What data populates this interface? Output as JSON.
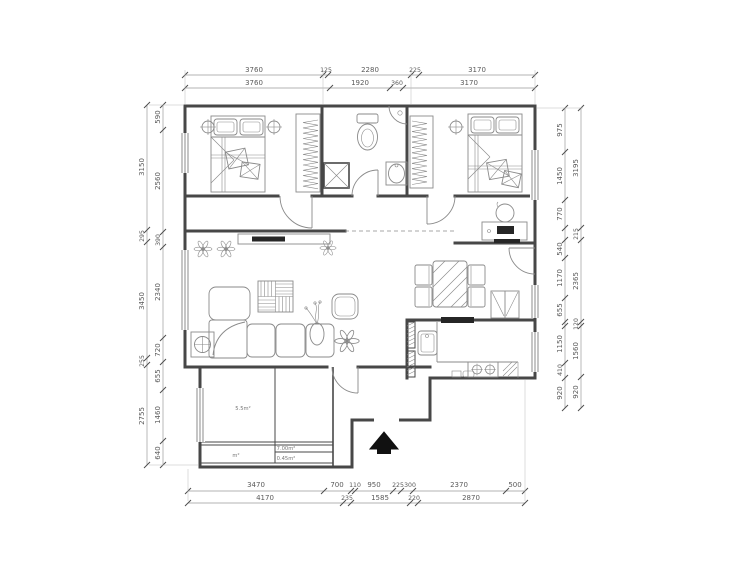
{
  "colors": {
    "background": "#ffffff",
    "wall": "#474747",
    "furniture": "#8a8a8a",
    "dim_line": "#9a9a9a",
    "dim_text": "#5a5a5a",
    "dark_fill": "#262626"
  },
  "dimensions": {
    "top_row1": [
      "3760",
      "125",
      "2280",
      "225",
      "3170"
    ],
    "top_row2": [
      "3760",
      "1920",
      "360",
      "3170"
    ],
    "bottom_row1": [
      "3470",
      "700",
      "110",
      "950",
      "225",
      "300",
      "2370",
      "500"
    ],
    "bottom_row2": [
      "4170",
      "235",
      "1585",
      "220",
      "2870"
    ],
    "left_outer": [
      "3150",
      "295",
      "3450",
      "255",
      "2755"
    ],
    "left_inner": [
      "590",
      "2560",
      "390",
      "2340",
      "720",
      "655",
      "1460",
      "640"
    ],
    "right_inner": [
      "975",
      "1450",
      "770",
      "540",
      "1170",
      "655",
      "1150",
      "410",
      "920"
    ],
    "right_outer": [
      "3195",
      "215",
      "2365",
      "120",
      "1560",
      "920"
    ]
  },
  "labels": {
    "room_area": "5.5m²",
    "balcony_area_left": "m²",
    "balcony_area_right_1": "7.00m²",
    "balcony_area_right_2": "0.45m²"
  }
}
